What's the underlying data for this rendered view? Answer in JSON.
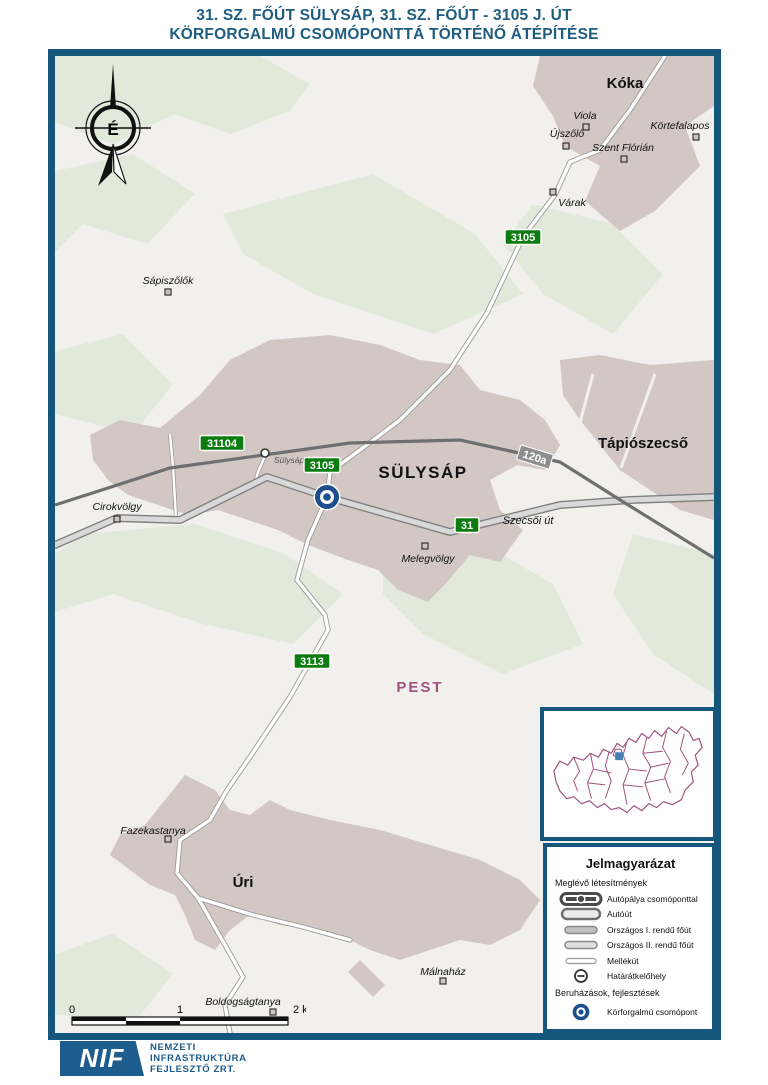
{
  "title": {
    "line1": "31. SZ. FŐÚT SÜLYSÁP, 31. SZ. FŐÚT - 3105 J. ÚT",
    "line2": "KÖRFORGALMÚ CSOMÓPONTTÁ TÖRTÉNŐ ÁTÉPÍTÉSE"
  },
  "map": {
    "compass_label": "É",
    "county_label": "PEST",
    "station_label": "Sülysáp",
    "street_label": "Szecsői út",
    "railway_shield": "120a",
    "towns": [
      {
        "label": "Kóka"
      },
      {
        "label": "SÜLYSÁP"
      },
      {
        "label": "Tápiószecső"
      },
      {
        "label": "Úri"
      }
    ],
    "settlements": [
      {
        "label": "Sápiszőlők"
      },
      {
        "label": "Viola"
      },
      {
        "label": "Újszőlő"
      },
      {
        "label": "Körtefalapos"
      },
      {
        "label": "Szent Flórián"
      },
      {
        "label": "Várak"
      },
      {
        "label": "Cirokvölgy"
      },
      {
        "label": "Melegvölgy"
      },
      {
        "label": "Fazekastanya"
      },
      {
        "label": "Málnaház"
      },
      {
        "label": "Boldogságtanya"
      }
    ],
    "road_shields": [
      {
        "label": "3105"
      },
      {
        "label": "31104"
      },
      {
        "label": "3105"
      },
      {
        "label": "31"
      },
      {
        "label": "3113"
      }
    ]
  },
  "scale_bar": {
    "tick0": "0",
    "tick1": "1",
    "tick2": "2 km"
  },
  "legend": {
    "title": "Jelmagyarázat",
    "sections": [
      {
        "heading": "Meglévő létesítmények",
        "items": [
          {
            "label": "Autópálya csomóponttal",
            "symbol": "motorway-with-junction"
          },
          {
            "label": "Autóút",
            "symbol": "expressway"
          },
          {
            "label": "Országos I. rendű főút",
            "symbol": "national-primary-road"
          },
          {
            "label": "Országos II. rendű főút",
            "symbol": "national-secondary-road"
          },
          {
            "label": "Mellékút",
            "symbol": "minor-road"
          },
          {
            "label": "Határátkelőhely",
            "symbol": "border-crossing"
          }
        ]
      },
      {
        "heading": "Beruházások, fejlesztések",
        "items": [
          {
            "label": "Körforgalmú csomópont",
            "symbol": "roundabout-junction"
          }
        ]
      }
    ]
  },
  "footer": {
    "logo_text": "NIF",
    "org_line1": "NEMZETI",
    "org_line2": "INFRASTRUKTÚRA",
    "org_line3": "FEJLESZTŐ ZRT."
  },
  "colors": {
    "frame_blue": "#15567d",
    "title_blue": "#1e5c80",
    "shield_green": "#0c7c10",
    "railway_shield_gray": "#8d8d8d",
    "county_purple": "#a0517d",
    "roundabout_blue": "#1d4f8c",
    "urban_area": "#d2c7c3",
    "green_area": "#e2e9db",
    "nif_blue": "#1d5c8c"
  }
}
